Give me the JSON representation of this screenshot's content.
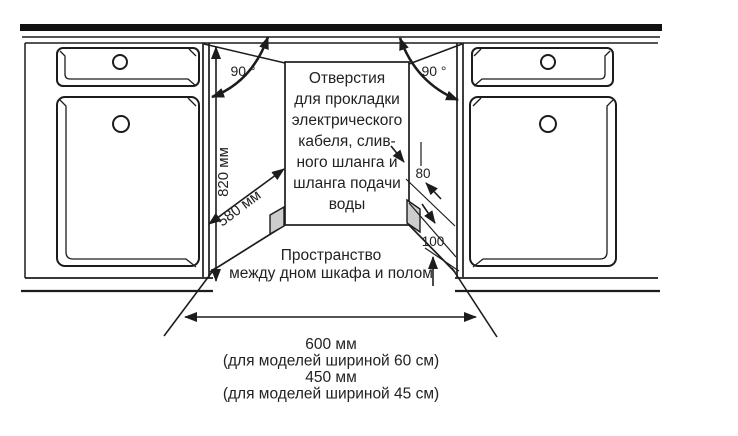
{
  "diagram": {
    "colors": {
      "line": "#1c1c1c",
      "top_bar": "#111111",
      "hole_fill": "#cdcdcd",
      "text": "#222222",
      "background": "#ffffff"
    },
    "labels": {
      "angle_left": "90 °",
      "angle_right": "90 °",
      "niche_height": "820 мм",
      "niche_depth": "580 мм",
      "hole_dim_top": "80",
      "hole_dim_bottom": "100",
      "holes_note": [
        "Отверстия",
        "для прокладки",
        "электрического",
        "кабеля, слив-",
        "ного шланга и",
        "шланга подачи",
        "воды"
      ],
      "floor_gap_note": [
        "Пространство",
        "между дном шкафа и полом"
      ],
      "width_note": [
        "600 мм",
        "(для моделей шириной 60 см)",
        "450 мм",
        "(для моделей шириной 45 см)"
      ]
    }
  }
}
